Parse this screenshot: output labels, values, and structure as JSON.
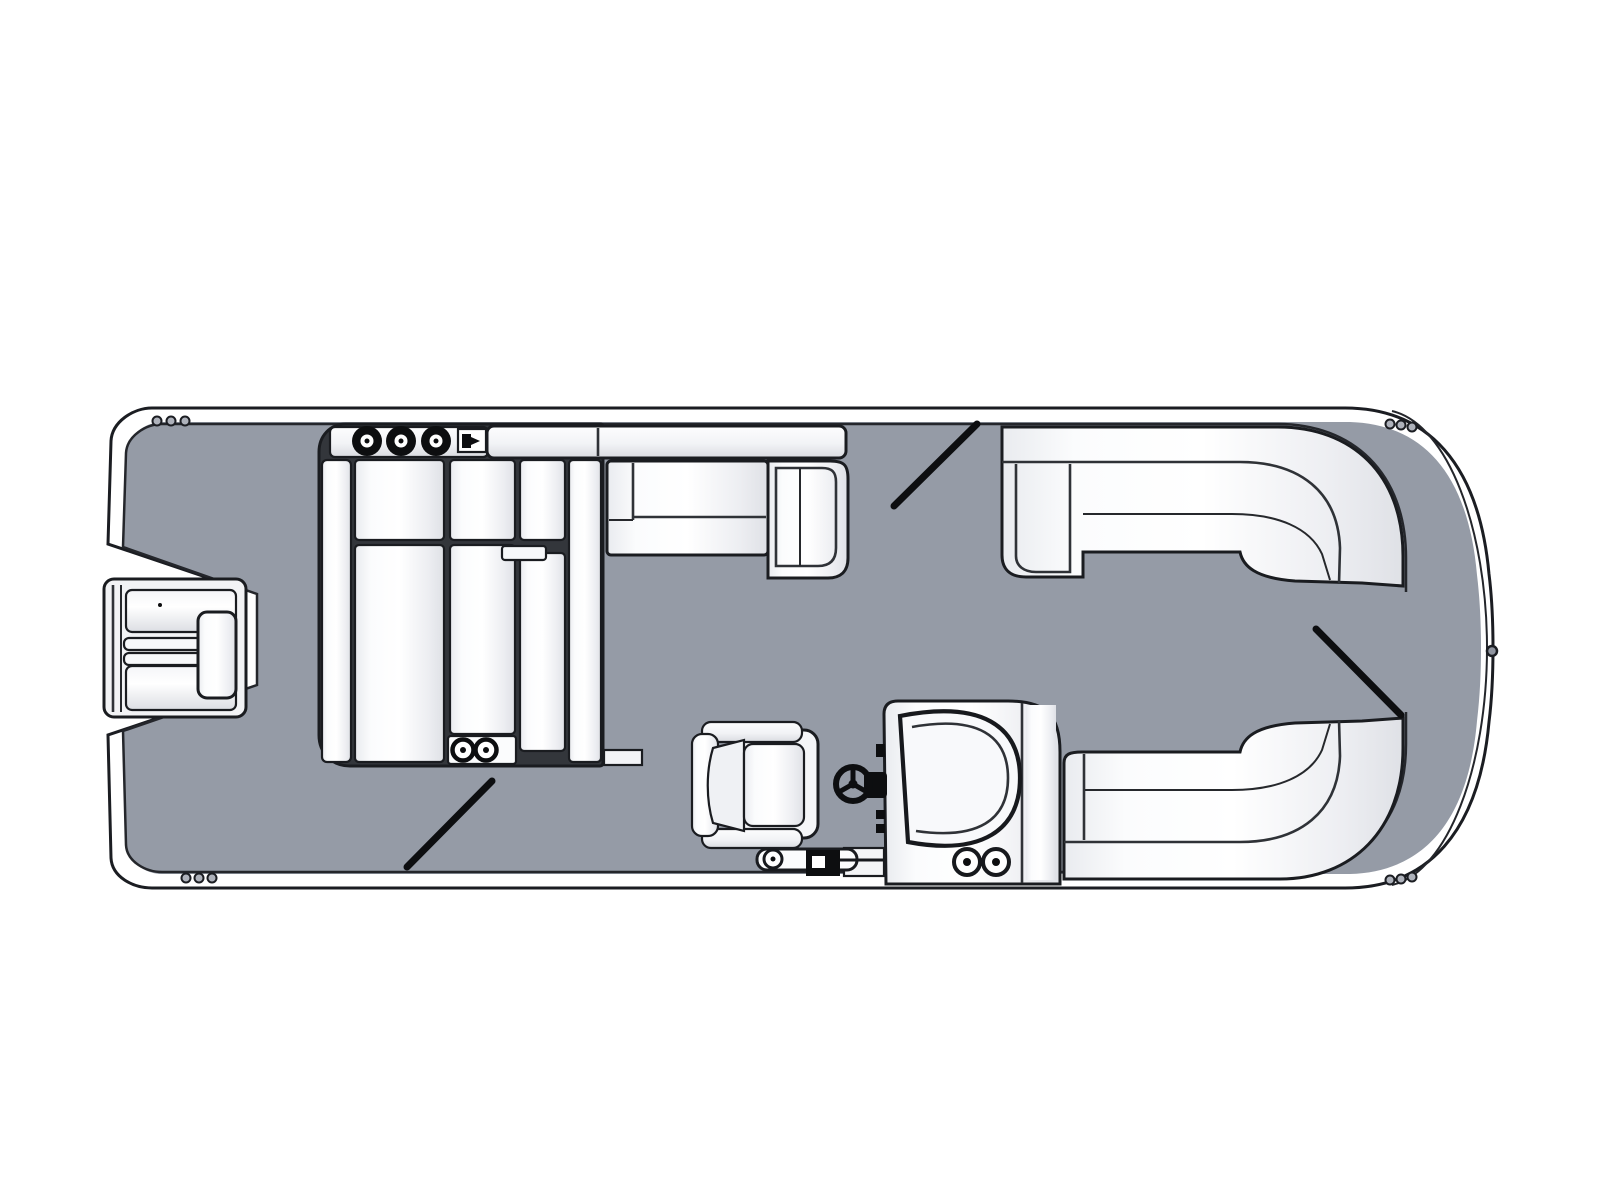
{
  "diagram": {
    "title": "Pontoon boat floor plan, top-down view",
    "type": "boat-floorplan",
    "background": "#FFFFFF",
    "colors": {
      "hull_band": "#9095A0",
      "deck": "#959BA6",
      "outline": "#1B1D22",
      "seam": "#2F3237",
      "cushion_white": "#FFFFFF",
      "cushion_shade": "#DCDEE3",
      "hardware_dark": "#0D0E10",
      "gate_line": "#0D0E10"
    },
    "features": [
      {
        "id": "stern-motor",
        "label": "Outboard motor at stern notch"
      },
      {
        "id": "port-stern-lounge",
        "label": "Large L-shaped stern lounge group"
      },
      {
        "id": "armrest-console",
        "label": "Stern lounge armrest console with cupholders"
      },
      {
        "id": "seat-cupholder-panel",
        "label": "Lounge seat-base panel with cupholders"
      },
      {
        "id": "port-midship-bench",
        "label": "Port midship bench with corner return seat"
      },
      {
        "id": "port-bow-lounge",
        "label": "Curved wraparound bow lounge, port side"
      },
      {
        "id": "starboard-bow-lounge",
        "label": "Curved wraparound bow lounge, starboard side"
      },
      {
        "id": "helm-console",
        "label": "Helm console with windshield and speakers"
      },
      {
        "id": "steering-wheel",
        "label": "Steering wheel"
      },
      {
        "id": "captain-chair",
        "label": "Captain's chair facing helm"
      },
      {
        "id": "stern-tow-bar",
        "label": "Ski tow / boarding hardware at starboard stern"
      },
      {
        "id": "port-gate",
        "label": "Port side boarding gate (diagonal marker)"
      },
      {
        "id": "starboard-stern-gate",
        "label": "Starboard stern boarding gate (diagonal marker)"
      },
      {
        "id": "bow-gate",
        "label": "Bow boarding gate (diagonal marker)"
      },
      {
        "id": "rail-hinges",
        "label": "Gate hinge dots on rails"
      },
      {
        "id": "bow-eye",
        "label": "Bow eye fitting"
      }
    ],
    "counts": {
      "armrest_cupholders": 3,
      "seat_cupholders": 2,
      "helm_speakers": 2,
      "gates": 3,
      "hinge_dot_groups": 4
    }
  }
}
